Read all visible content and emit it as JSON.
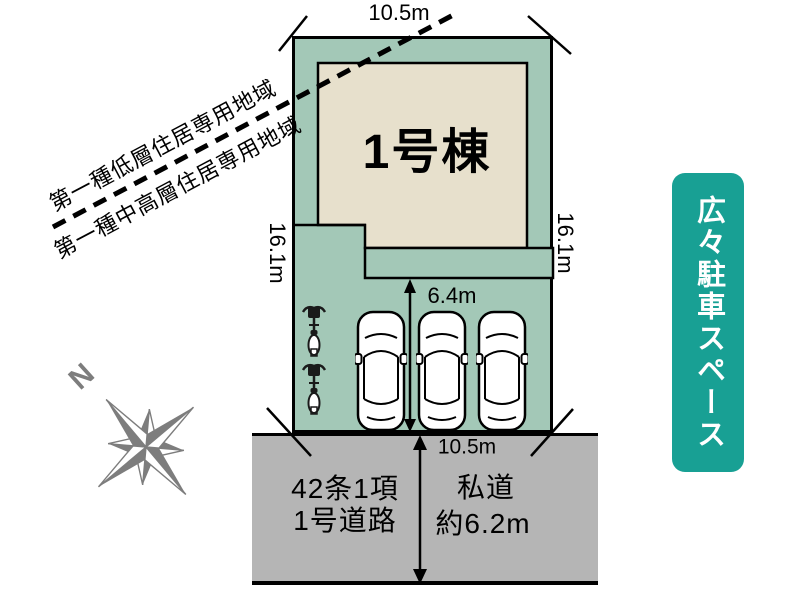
{
  "site_plan": {
    "building": {
      "label": "1号棟"
    },
    "dimensions": {
      "top_width": "10.5m",
      "left_depth": "16.1m",
      "right_depth": "16.1m",
      "parking_depth": "6.4m",
      "frontage": "10.5m"
    },
    "zoning": {
      "line1": "第一種低層住居専用地域",
      "line2": "第一種中高層住居専用地域"
    },
    "road": {
      "type_line1": "42条1項",
      "type_line2": "1号道路",
      "kind": "私道",
      "width": "約6.2m"
    },
    "compass": {
      "label": "N"
    },
    "banner": {
      "text": "広々駐車スペース"
    },
    "icons": {
      "car_icon": "car-top-view",
      "car_count": 3,
      "bicycle_icon": "bicycle-top-view",
      "bicycle_count": 2,
      "compass_icon": "compass-rose"
    },
    "colors": {
      "plot": "#a3c8b7",
      "building": "#e7e0cc",
      "road": "#b5b5b5",
      "banner": "#18a094",
      "compass": "#7d7d7d",
      "line": "#000000"
    }
  }
}
